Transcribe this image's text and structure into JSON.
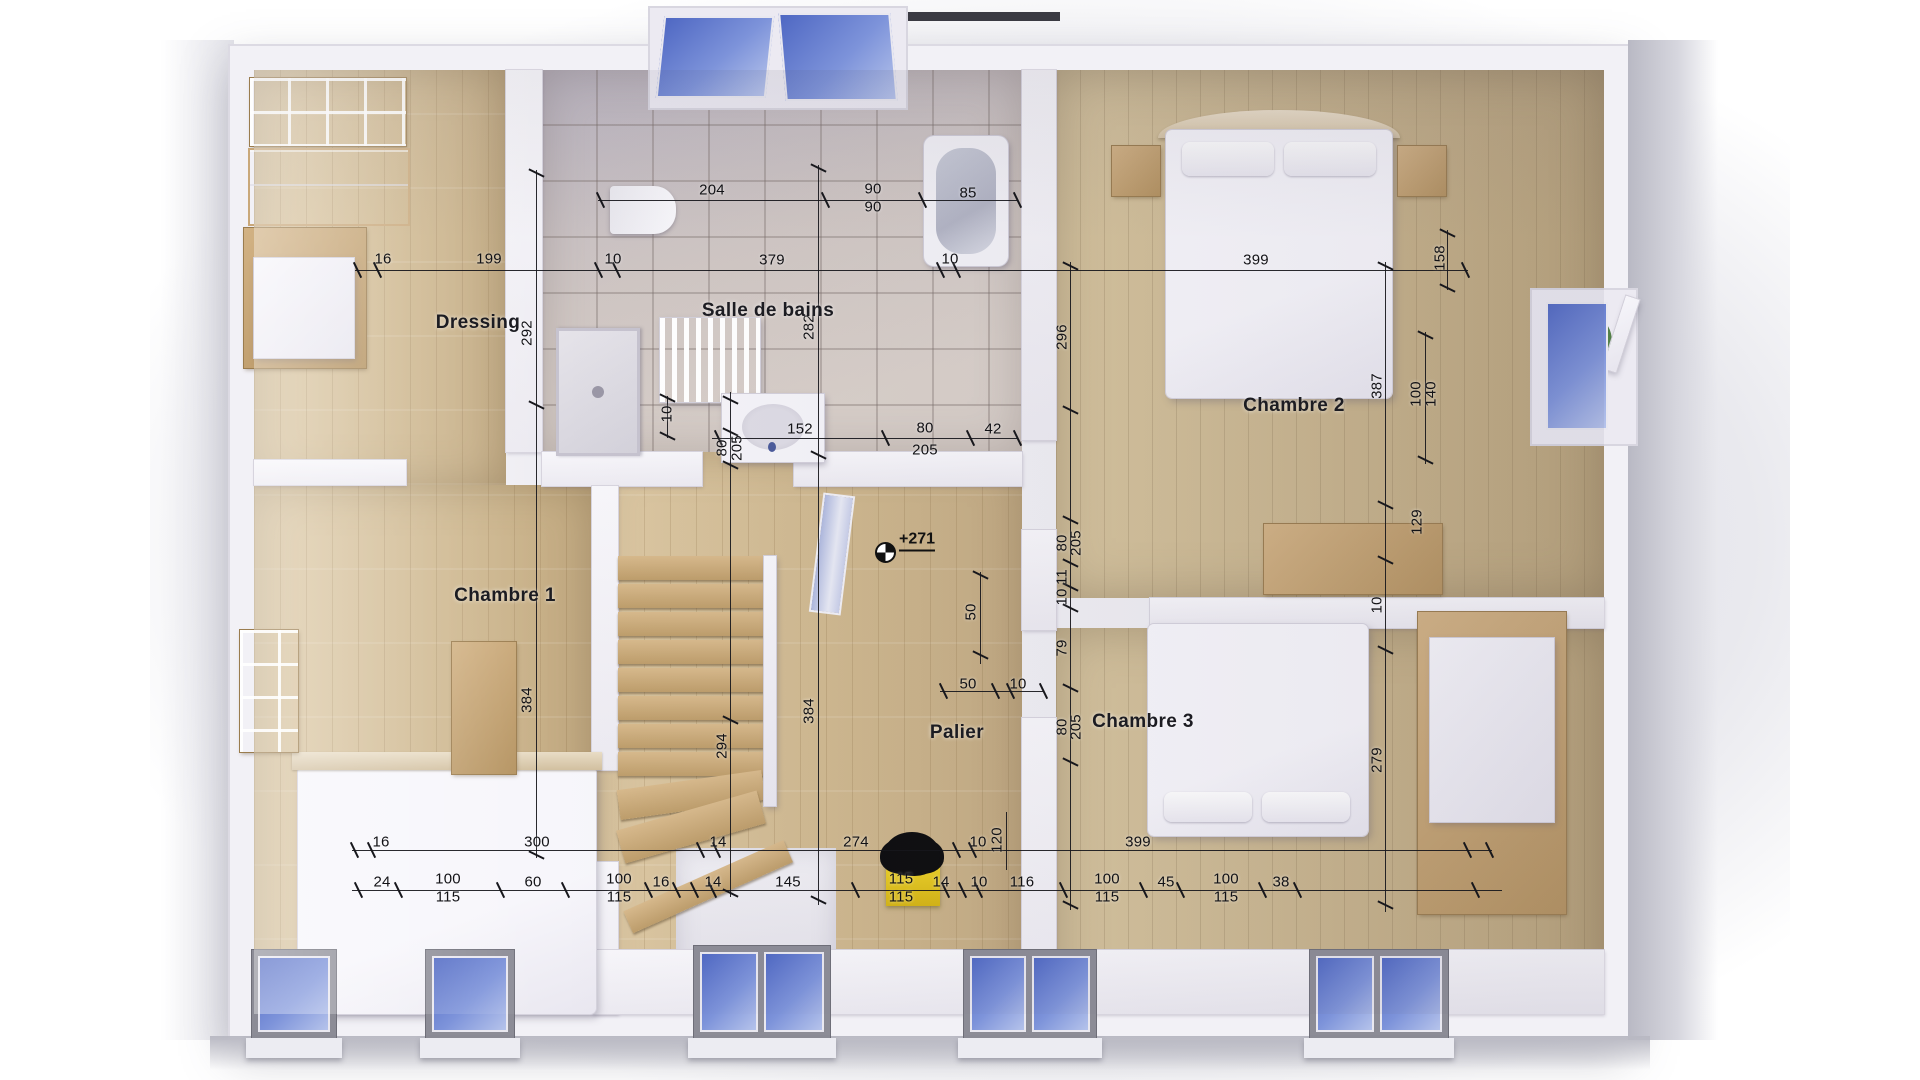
{
  "rooms": [
    {
      "label": "Dressing",
      "x": 478,
      "y": 323
    },
    {
      "label": "Salle de bains",
      "x": 768,
      "y": 311
    },
    {
      "label": "Chambre 1",
      "x": 505,
      "y": 596
    },
    {
      "label": "Chambre 2",
      "x": 1294,
      "y": 406
    },
    {
      "label": "Chambre 3",
      "x": 1143,
      "y": 722
    },
    {
      "label": "Palier",
      "x": 957,
      "y": 733
    }
  ],
  "marker": {
    "label": "+271",
    "text_x": 917,
    "text_y": 541,
    "circle_x": 884,
    "circle_y": 551
  },
  "dimensions": [
    {
      "t": "204",
      "x": 712,
      "y": 190,
      "r": 0
    },
    {
      "t": "90",
      "x": 873,
      "y": 189,
      "r": 0
    },
    {
      "t": "90",
      "x": 873,
      "y": 207,
      "r": 0
    },
    {
      "t": "85",
      "x": 968,
      "y": 193,
      "r": 0
    },
    {
      "t": "16",
      "x": 383,
      "y": 259,
      "r": 0
    },
    {
      "t": "199",
      "x": 489,
      "y": 259,
      "r": 0
    },
    {
      "t": "10",
      "x": 613,
      "y": 259,
      "r": 0
    },
    {
      "t": "379",
      "x": 772,
      "y": 260,
      "r": 0
    },
    {
      "t": "10",
      "x": 950,
      "y": 259,
      "r": 0
    },
    {
      "t": "399",
      "x": 1256,
      "y": 260,
      "r": 0
    },
    {
      "t": "158",
      "x": 1440,
      "y": 258,
      "r": 1
    },
    {
      "t": "292",
      "x": 527,
      "y": 333,
      "r": 1
    },
    {
      "t": "282",
      "x": 809,
      "y": 327,
      "r": 1
    },
    {
      "t": "296",
      "x": 1062,
      "y": 337,
      "r": 1
    },
    {
      "t": "387",
      "x": 1377,
      "y": 386,
      "r": 1
    },
    {
      "t": "100",
      "x": 1416,
      "y": 394,
      "r": 1
    },
    {
      "t": "140",
      "x": 1431,
      "y": 394,
      "r": 1
    },
    {
      "t": "152",
      "x": 800,
      "y": 429,
      "r": 0
    },
    {
      "t": "80",
      "x": 925,
      "y": 428,
      "r": 0
    },
    {
      "t": "205",
      "x": 925,
      "y": 450,
      "r": 0
    },
    {
      "t": "42",
      "x": 993,
      "y": 429,
      "r": 0
    },
    {
      "t": "10",
      "x": 667,
      "y": 414,
      "r": 1
    },
    {
      "t": "80",
      "x": 722,
      "y": 448,
      "r": 1
    },
    {
      "t": "205",
      "x": 737,
      "y": 448,
      "r": 1
    },
    {
      "t": "384",
      "x": 527,
      "y": 700,
      "r": 1
    },
    {
      "t": "384",
      "x": 809,
      "y": 711,
      "r": 1
    },
    {
      "t": "294",
      "x": 722,
      "y": 746,
      "r": 1
    },
    {
      "t": "80",
      "x": 1062,
      "y": 543,
      "r": 1
    },
    {
      "t": "205",
      "x": 1076,
      "y": 543,
      "r": 1
    },
    {
      "t": "11",
      "x": 1062,
      "y": 577,
      "r": 1
    },
    {
      "t": "10",
      "x": 1062,
      "y": 597,
      "r": 1
    },
    {
      "t": "79",
      "x": 1062,
      "y": 648,
      "r": 1
    },
    {
      "t": "80",
      "x": 1062,
      "y": 727,
      "r": 1
    },
    {
      "t": "205",
      "x": 1076,
      "y": 727,
      "r": 1
    },
    {
      "t": "50",
      "x": 971,
      "y": 612,
      "r": 1
    },
    {
      "t": "50",
      "x": 968,
      "y": 684,
      "r": 0
    },
    {
      "t": "10",
      "x": 1018,
      "y": 684,
      "r": 0
    },
    {
      "t": "129",
      "x": 1417,
      "y": 522,
      "r": 1
    },
    {
      "t": "10",
      "x": 1377,
      "y": 605,
      "r": 1
    },
    {
      "t": "279",
      "x": 1377,
      "y": 760,
      "r": 1
    },
    {
      "t": "120",
      "x": 997,
      "y": 840,
      "r": 1
    },
    {
      "t": "16",
      "x": 381,
      "y": 842,
      "r": 0
    },
    {
      "t": "300",
      "x": 537,
      "y": 842,
      "r": 0
    },
    {
      "t": "14",
      "x": 718,
      "y": 842,
      "r": 0
    },
    {
      "t": "274",
      "x": 856,
      "y": 842,
      "r": 0
    },
    {
      "t": "10",
      "x": 978,
      "y": 842,
      "r": 0
    },
    {
      "t": "399",
      "x": 1138,
      "y": 842,
      "r": 0
    },
    {
      "t": "24",
      "x": 382,
      "y": 882,
      "r": 0
    },
    {
      "t": "100",
      "x": 448,
      "y": 879,
      "r": 0
    },
    {
      "t": "115",
      "x": 448,
      "y": 897,
      "r": 0
    },
    {
      "t": "60",
      "x": 533,
      "y": 882,
      "r": 0
    },
    {
      "t": "100",
      "x": 619,
      "y": 879,
      "r": 0
    },
    {
      "t": "115",
      "x": 619,
      "y": 897,
      "r": 0
    },
    {
      "t": "16",
      "x": 661,
      "y": 882,
      "r": 0
    },
    {
      "t": "14",
      "x": 713,
      "y": 882,
      "r": 0
    },
    {
      "t": "145",
      "x": 788,
      "y": 882,
      "r": 0
    },
    {
      "t": "115",
      "x": 901,
      "y": 879,
      "r": 0
    },
    {
      "t": "115",
      "x": 901,
      "y": 897,
      "r": 0
    },
    {
      "t": "14",
      "x": 941,
      "y": 882,
      "r": 0
    },
    {
      "t": "10",
      "x": 979,
      "y": 882,
      "r": 0
    },
    {
      "t": "116",
      "x": 1022,
      "y": 882,
      "r": 0
    },
    {
      "t": "100",
      "x": 1107,
      "y": 879,
      "r": 0
    },
    {
      "t": "115",
      "x": 1107,
      "y": 897,
      "r": 0
    },
    {
      "t": "45",
      "x": 1166,
      "y": 882,
      "r": 0
    },
    {
      "t": "100",
      "x": 1226,
      "y": 879,
      "r": 0
    },
    {
      "t": "115",
      "x": 1226,
      "y": 897,
      "r": 0
    },
    {
      "t": "38",
      "x": 1281,
      "y": 882,
      "r": 0
    }
  ],
  "colors": {
    "glass_blue": "#4d66c2",
    "wood_floor": "#d5c09b",
    "tile_floor": "#cfc6c3",
    "wall_white": "#f2f1f6",
    "stool_yellow": "#e6c71e",
    "dim_line": "#17171c"
  }
}
